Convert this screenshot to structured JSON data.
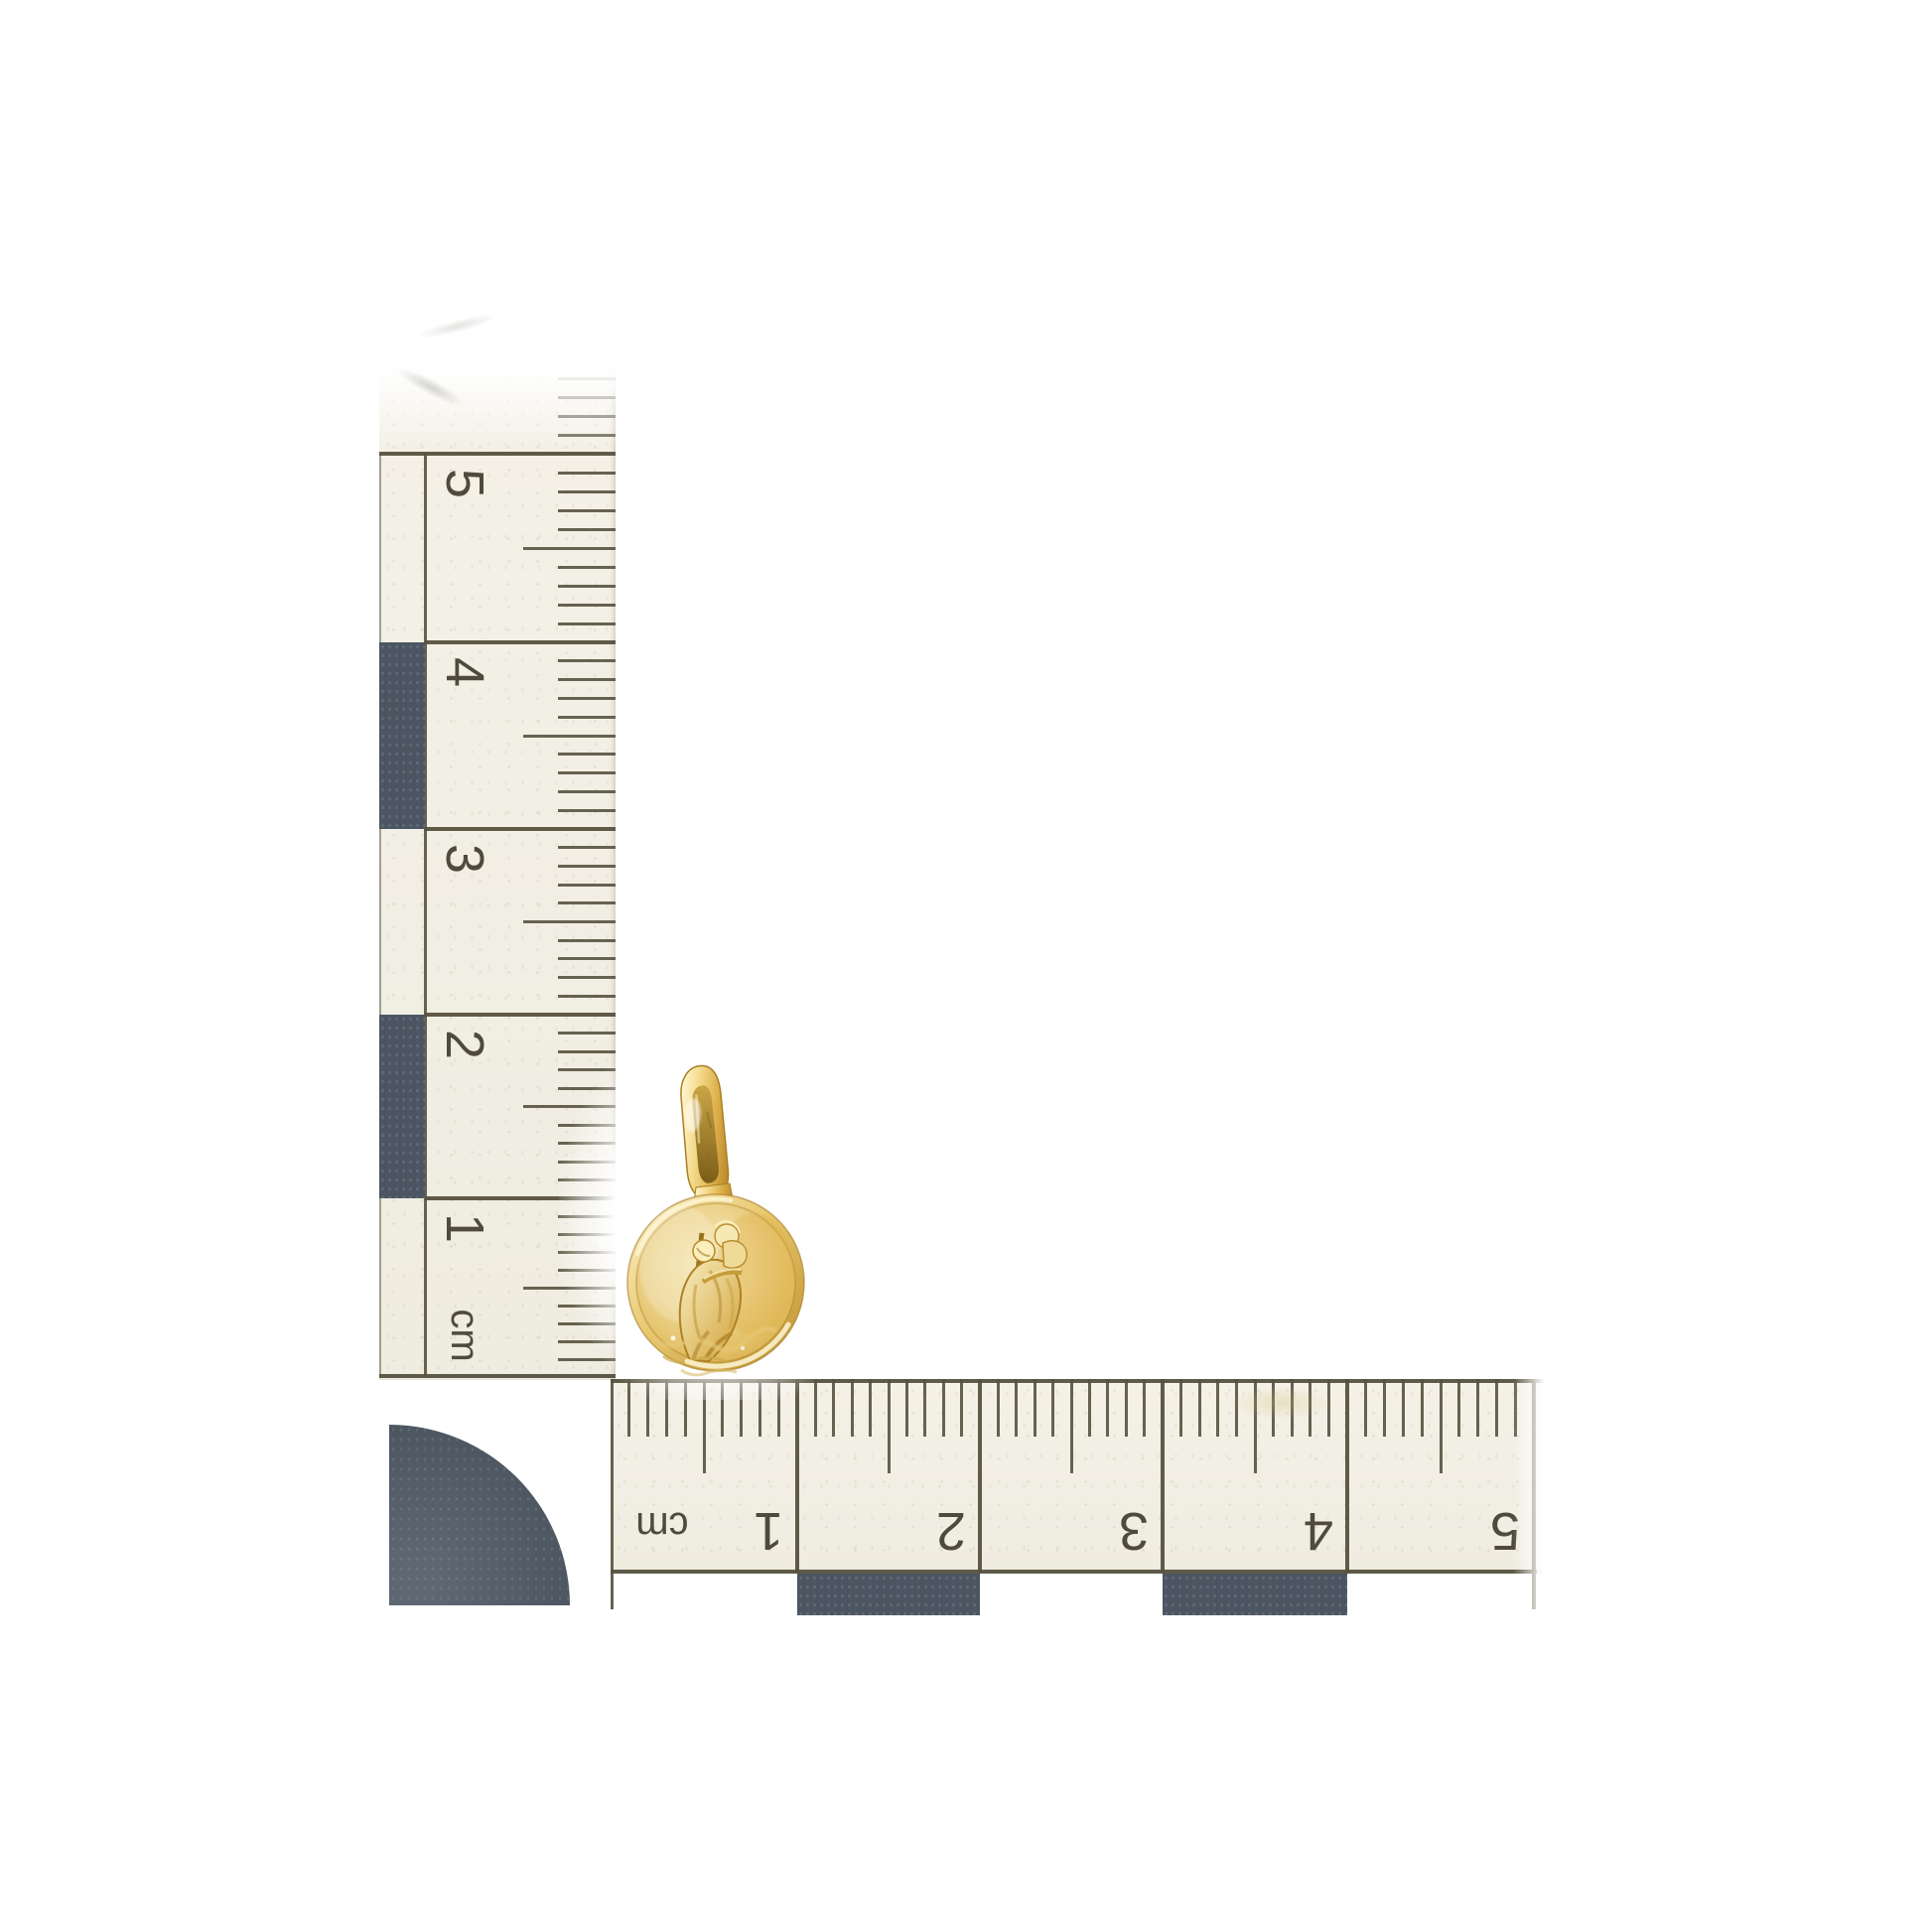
{
  "scene": {
    "background_color": "#ffffff",
    "subject": "gold round medal pendant with L-shaped centimetre photo scale"
  },
  "vertical_scale": {
    "labels": [
      "5",
      "4",
      "3",
      "2",
      "1",
      "cm"
    ]
  },
  "horizontal_scale": {
    "labels": [
      "cm",
      "1",
      "2",
      "3",
      "4",
      "5"
    ]
  },
  "colors": {
    "scale_body": "#f2efe4",
    "scale_markings": "#56523f",
    "scale_digit": "#4f4b3c",
    "scale_block_slate": "#4c5662",
    "corner_block_slate": "#525c66",
    "pendant_gold": "#e4bd5d",
    "pendant_gold_light": "#fdf4cc",
    "pendant_gold_deep": "#b9892c"
  },
  "pendant": {
    "kind": "st-christopher-medal",
    "relief": "figure with staff carrying child",
    "parts": [
      "bail",
      "round medal disc"
    ]
  }
}
